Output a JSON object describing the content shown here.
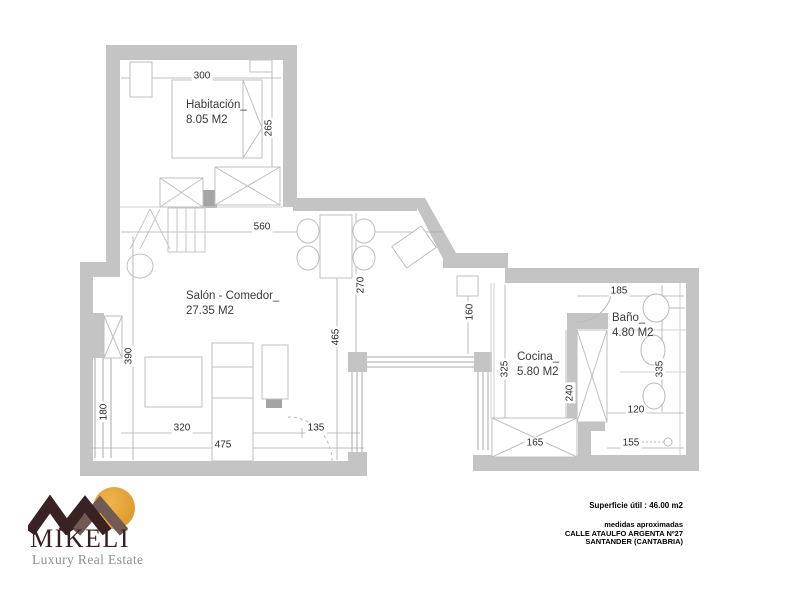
{
  "brand": {
    "name": "MIKELI",
    "tagline": "Luxury Real Estate",
    "colors": {
      "logo_dark": "#3A2124",
      "logo_taupe": "#6F5B54",
      "logo_sun": "#E2A136",
      "wall_gray": "#C4C4C4"
    }
  },
  "plan": {
    "rooms": [
      {
        "name": "Habitación_",
        "area": "8.05 M2"
      },
      {
        "name": "Salón - Comedor_",
        "area": "27.35 M2"
      },
      {
        "name": "Cocina_",
        "area": "5.80 M2"
      },
      {
        "name": "Baño_",
        "area": "4.80 M2"
      }
    ],
    "dims": {
      "d300": "300",
      "d265": "265",
      "d560": "560",
      "d270": "270",
      "d465": "465",
      "d160": "160",
      "d390": "390",
      "d180": "180",
      "d320": "320",
      "d475": "475",
      "d135": "135",
      "d325": "325",
      "d240": "240",
      "d165": "165",
      "d185": "185",
      "d335": "335",
      "d120": "120",
      "d155": "155"
    }
  },
  "info": {
    "superficie": "Superficie útil : 46.00 m2",
    "note": "medidas aproximadas",
    "address1": "CALLE  ATAULFO ARGENTA   Nº27",
    "address2": "SANTANDER  (CANTABRIA)"
  }
}
